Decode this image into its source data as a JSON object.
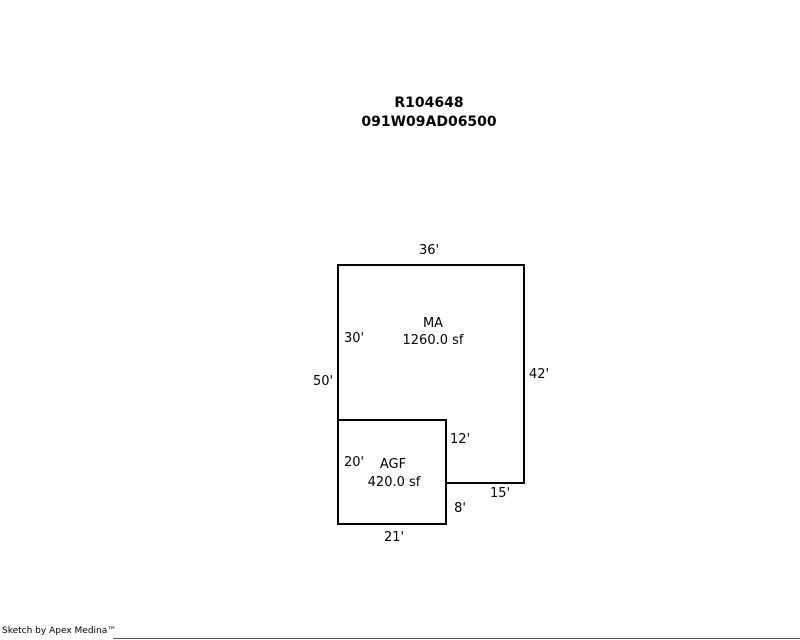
{
  "page": {
    "title_line1": "R104648",
    "title_line2": "091W09AD06500"
  },
  "sketch": {
    "areas": {
      "ma": {
        "code": "MA",
        "area": "1260.0 sf"
      },
      "agf": {
        "code": "AGF",
        "area": "420.0 sf"
      }
    },
    "dimensions": {
      "top": "36'",
      "right": "42'",
      "left_total": "50'",
      "left_upper": "30'",
      "left_lower": "20'",
      "inner_vertical": "12'",
      "step_right": "15'",
      "step_down": "8'",
      "bottom": "21'"
    }
  },
  "footer": {
    "credit": "Sketch by Apex Medina™"
  },
  "colors": {
    "background": "#ffffff",
    "line": "#000000",
    "text": "#000000"
  }
}
